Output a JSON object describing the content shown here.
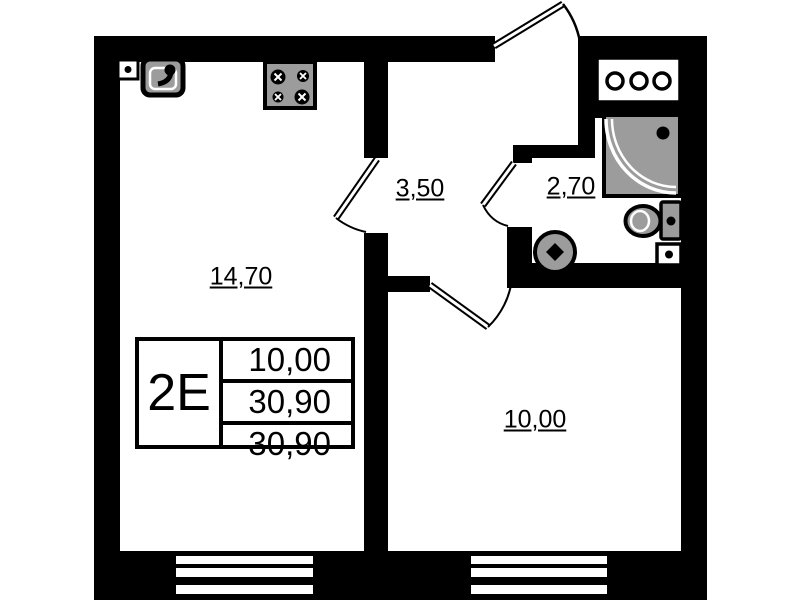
{
  "plan": {
    "type": "apartment-floor-plan",
    "rooms": {
      "living": {
        "name": "kitchen-living-room",
        "area": "14,70"
      },
      "hallway": {
        "name": "hallway",
        "area": "3,50"
      },
      "bathroom": {
        "name": "bathroom",
        "area": "2,70"
      },
      "bedroom": {
        "name": "bedroom",
        "area": "10,00"
      }
    },
    "stamp": {
      "unit_type": "2E",
      "values": [
        "10,00",
        "30,90",
        "30,90"
      ]
    },
    "fixtures": [
      "kitchen-sink",
      "stove",
      "power-outlet",
      "ventilation-shaft",
      "shower-tray",
      "toilet",
      "wash-basin",
      "power-outlet"
    ],
    "colors": {
      "wall": "#000000",
      "bg": "#ffffff",
      "fixture": "#9c9c9c",
      "line": "#000000"
    }
  }
}
